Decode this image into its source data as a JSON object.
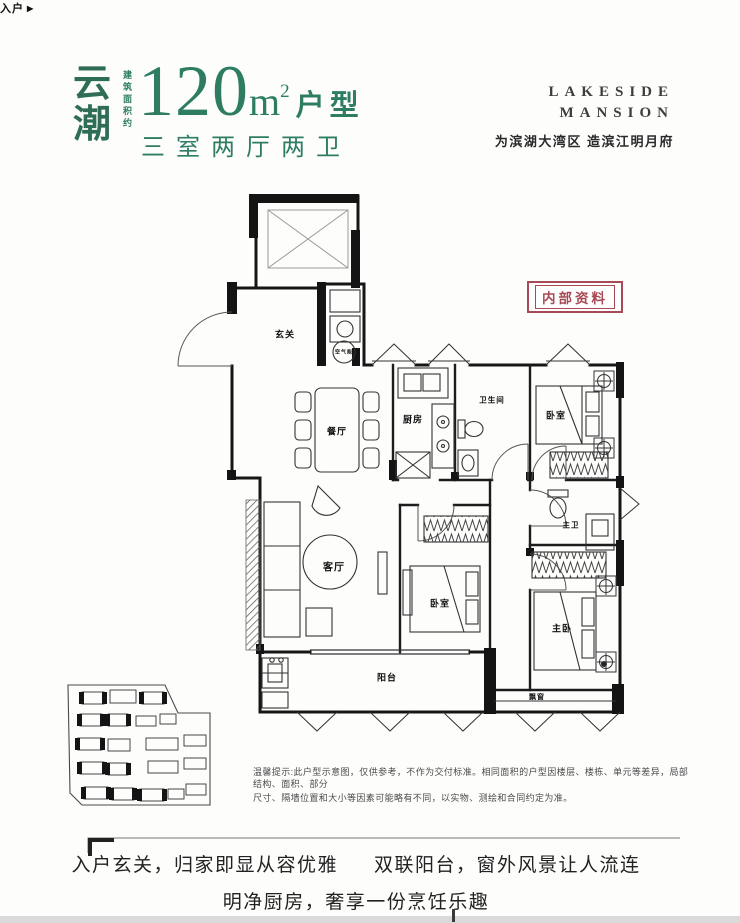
{
  "header": {
    "brand": "云潮",
    "area_prefix": "建筑面积约",
    "area_value": "120",
    "area_unit": "m",
    "area_exp": "2",
    "area_type": "户型",
    "layout": "三室两厅两卫",
    "logo": {
      "line1": "LAKESIDE",
      "line2": "MANSION"
    },
    "tagline": "为滨湖大湾区 造滨江明月府",
    "accent_green": "#2e7d62"
  },
  "stamp": {
    "text": "内部资料",
    "color": "#a84a55"
  },
  "floorplan": {
    "entry": {
      "label": "入户",
      "arrow": "▶"
    },
    "rooms": [
      {
        "label": "玄关",
        "x": 285,
        "y": 334,
        "size": 9
      },
      {
        "label": "餐厅",
        "x": 337,
        "y": 431,
        "size": 9
      },
      {
        "label": "厨房",
        "x": 413,
        "y": 419,
        "size": 9
      },
      {
        "label": "卫生间",
        "x": 492,
        "y": 400,
        "size": 7.5
      },
      {
        "label": "卧室",
        "x": 556,
        "y": 415,
        "size": 9
      },
      {
        "label": "客厅",
        "x": 334,
        "y": 566,
        "size": 10
      },
      {
        "label": "卧室",
        "x": 440,
        "y": 603,
        "size": 9
      },
      {
        "label": "主卫",
        "x": 571,
        "y": 525,
        "size": 7.5
      },
      {
        "label": "主卧",
        "x": 562,
        "y": 628,
        "size": 9
      },
      {
        "label": "阳台",
        "x": 387,
        "y": 677,
        "size": 9
      },
      {
        "label": "飘窗",
        "x": 537,
        "y": 697,
        "size": 7
      },
      {
        "label": "空气能",
        "x": 344,
        "y": 352,
        "size": 5
      }
    ]
  },
  "disclaimer": {
    "line1": "温馨提示:此户型示意图，仅供参考，不作为交付标准。相同面积的户型因楼层、楼栋、单元等差异，局部结构、面积、部分",
    "line2": "尺寸、隔墙位置和大小等因素可能略有不同，以实物、测绘和合同约定为准。"
  },
  "slogans": {
    "line1a": "入户玄关，归家即显从容优雅",
    "line1b": "双联阳台，窗外风景让人流连",
    "line2": "明净厨房，奢享一份烹饪乐趣"
  }
}
